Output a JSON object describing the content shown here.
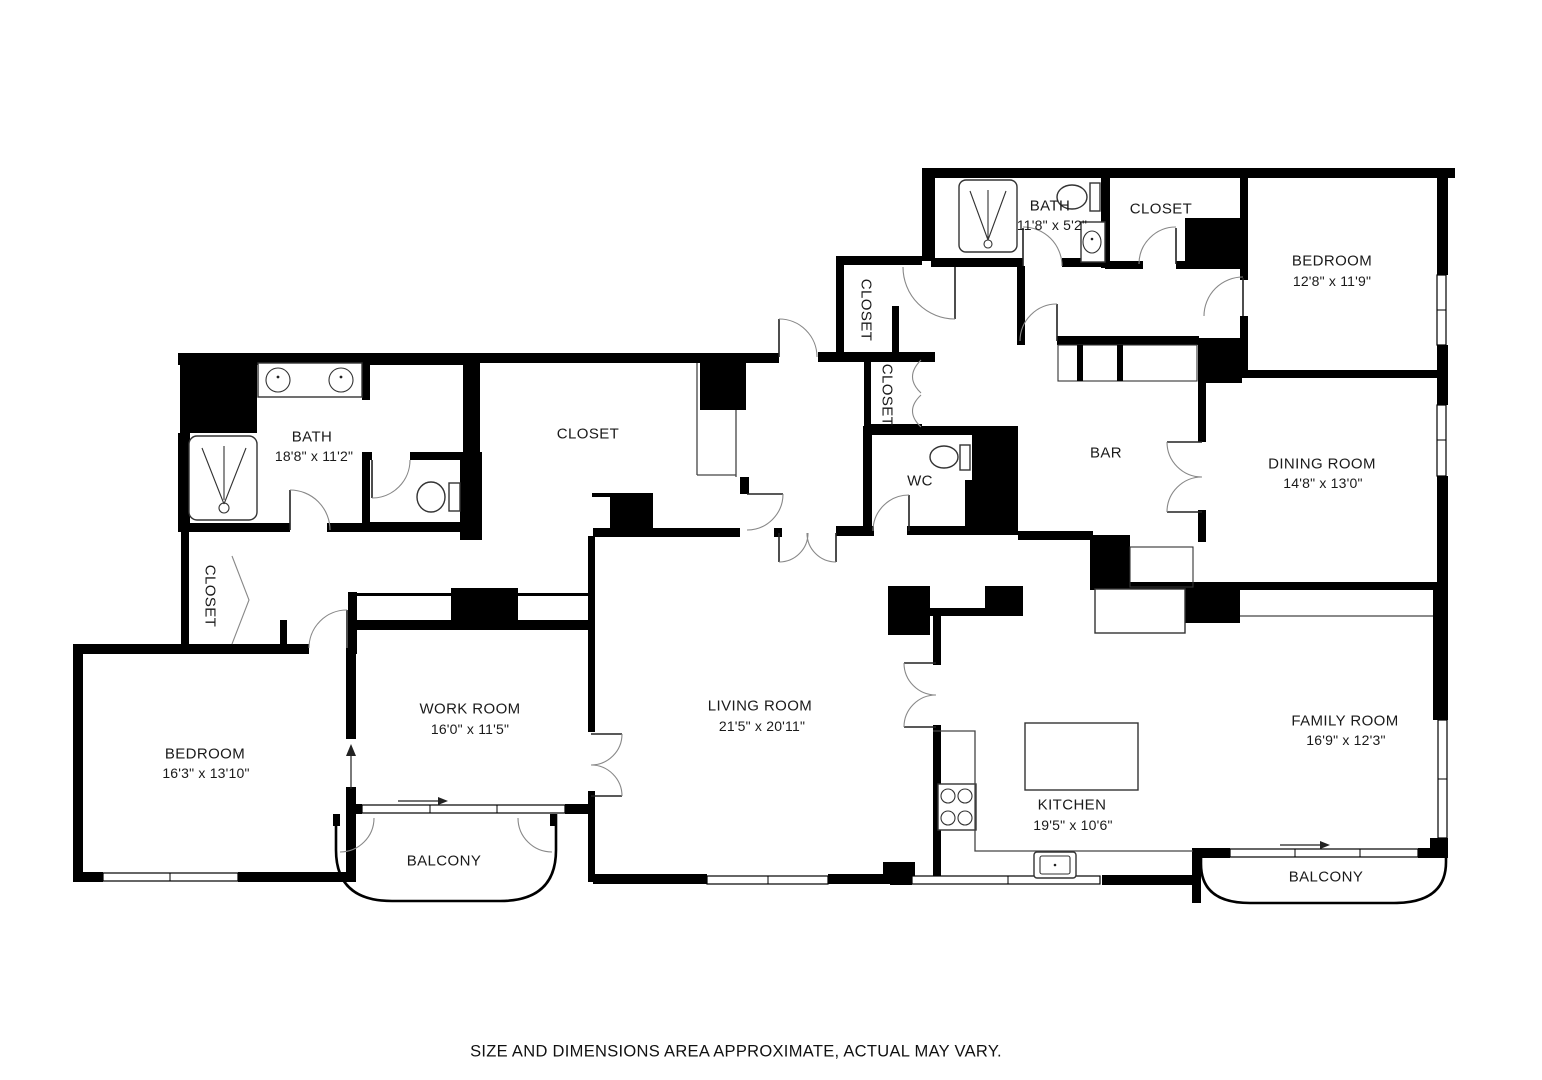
{
  "disclaimer": "SIZE AND DIMENSIONS AREA APPROXIMATE, ACTUAL MAY VARY.",
  "rooms": {
    "bath_left": {
      "name": "BATH",
      "dims": "18'8\" x 11'2\""
    },
    "closet_left": {
      "name": "CLOSET"
    },
    "closet_center": {
      "name": "CLOSET"
    },
    "bedroom_left": {
      "name": "BEDROOM",
      "dims": "16'3\" x 13'10\""
    },
    "work_room": {
      "name": "WORK ROOM",
      "dims": "16'0\" x 11'5\""
    },
    "living_room": {
      "name": "LIVING ROOM",
      "dims": "21'5\" x 20'11\""
    },
    "balcony_left": {
      "name": "BALCONY"
    },
    "closet_hall_upper": {
      "name": "CLOSET"
    },
    "closet_hall_lower": {
      "name": "CLOSET"
    },
    "wc": {
      "name": "WC"
    },
    "bath_top": {
      "name": "BATH",
      "dims": "11'8\" x 5'2\""
    },
    "closet_top": {
      "name": "CLOSET"
    },
    "bedroom_top": {
      "name": "BEDROOM",
      "dims": "12'8\" x 11'9\""
    },
    "bar": {
      "name": "BAR"
    },
    "dining_room": {
      "name": "DINING ROOM",
      "dims": "14'8\" x 13'0\""
    },
    "kitchen": {
      "name": "KITCHEN",
      "dims": "19'5\" x 10'6\""
    },
    "family_room": {
      "name": "FAMILY ROOM",
      "dims": "16'9\" x 12'3\""
    },
    "balcony_right": {
      "name": "BALCONY"
    }
  }
}
